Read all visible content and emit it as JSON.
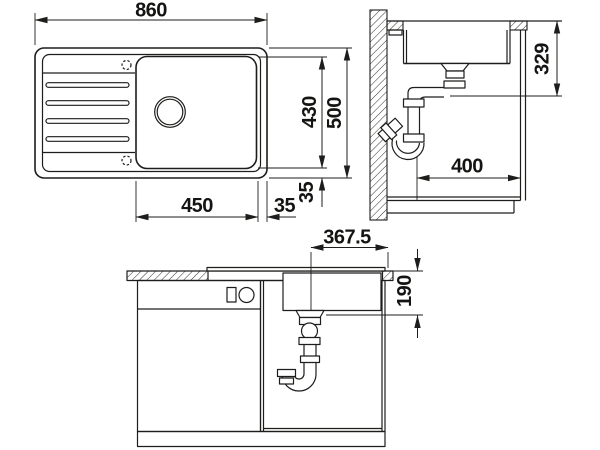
{
  "drawing": {
    "description": "sink-installation-dimension-drawing",
    "colors": {
      "line": "#1d1d1b",
      "background": "#ffffff"
    },
    "views": {
      "plan": {
        "dims": {
          "overall_width": "860",
          "overall_depth": "500",
          "inner_depth": "430",
          "bowl_length": "450",
          "gap_right": "35",
          "gap_bottom": "35"
        }
      },
      "side": {
        "dims": {
          "outlet_below_worktop": "329",
          "cabinet_inner_width": "400"
        }
      },
      "front": {
        "dims": {
          "drain_center_to_edge": "367.5",
          "depth_below_worktop": "190"
        }
      }
    }
  }
}
